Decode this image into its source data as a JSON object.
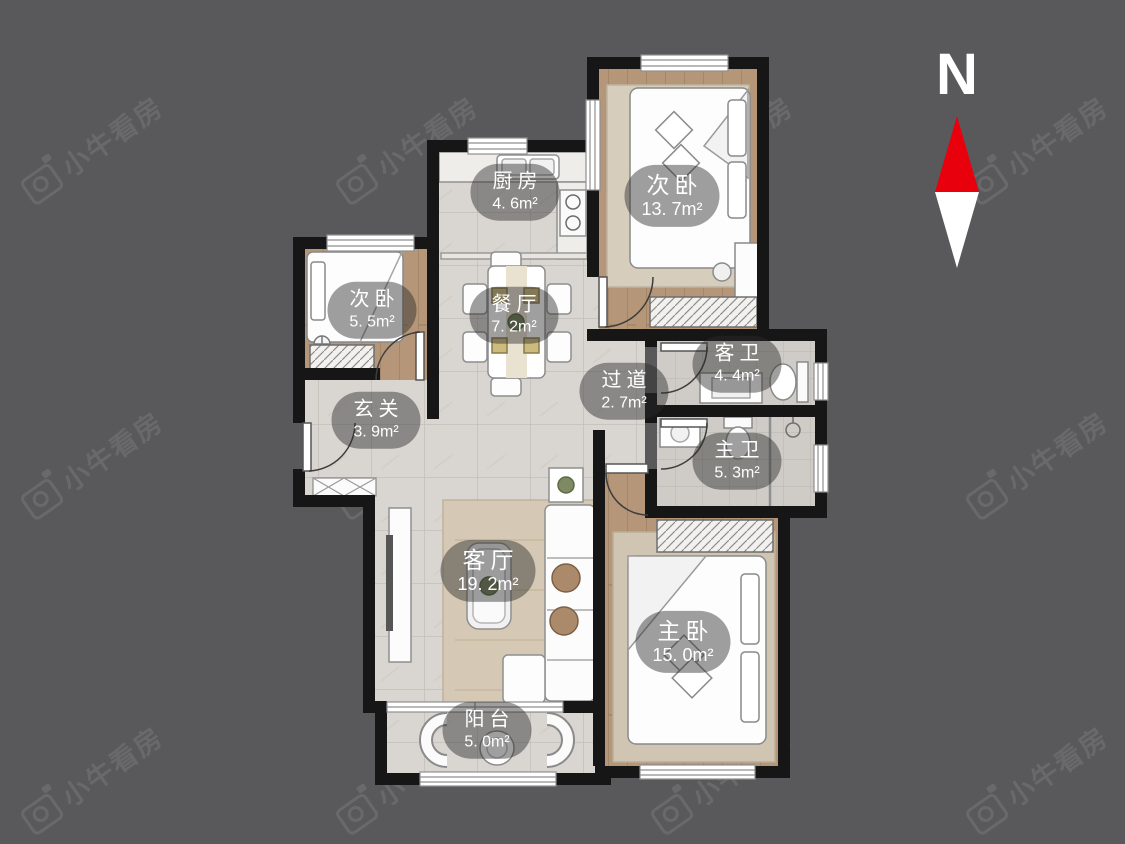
{
  "compass": {
    "label": "N"
  },
  "watermark": {
    "text": "小牛看房"
  },
  "colors": {
    "background": "#59595b",
    "wall": "#161616",
    "compass_north": "#e8000d",
    "compass_south": "#ffffff",
    "label_bubble": "rgba(42,42,42,0.45)",
    "tile_floor": "#d9d6d1",
    "bath_floor": "#cfccc7",
    "wood_floor": "#b59678"
  },
  "rooms": [
    {
      "id": "kitchen",
      "name": "厨房",
      "area": "4. 6m²"
    },
    {
      "id": "bedroom-2",
      "name": "次卧",
      "area": "13. 7m²"
    },
    {
      "id": "bedroom-3",
      "name": "次卧",
      "area": "5. 5m²"
    },
    {
      "id": "dining",
      "name": "餐厅",
      "area": "7. 2m²"
    },
    {
      "id": "entry",
      "name": "玄关",
      "area": "3. 9m²"
    },
    {
      "id": "hallway",
      "name": "过道",
      "area": "2. 7m²"
    },
    {
      "id": "guest-bath",
      "name": "客卫",
      "area": "4. 4m²"
    },
    {
      "id": "master-bath",
      "name": "主卫",
      "area": "5. 3m²"
    },
    {
      "id": "living",
      "name": "客厅",
      "area": "19. 2m²"
    },
    {
      "id": "master-bedroom",
      "name": "主卧",
      "area": "15. 0m²"
    },
    {
      "id": "balcony",
      "name": "阳台",
      "area": "5. 0m²"
    }
  ]
}
